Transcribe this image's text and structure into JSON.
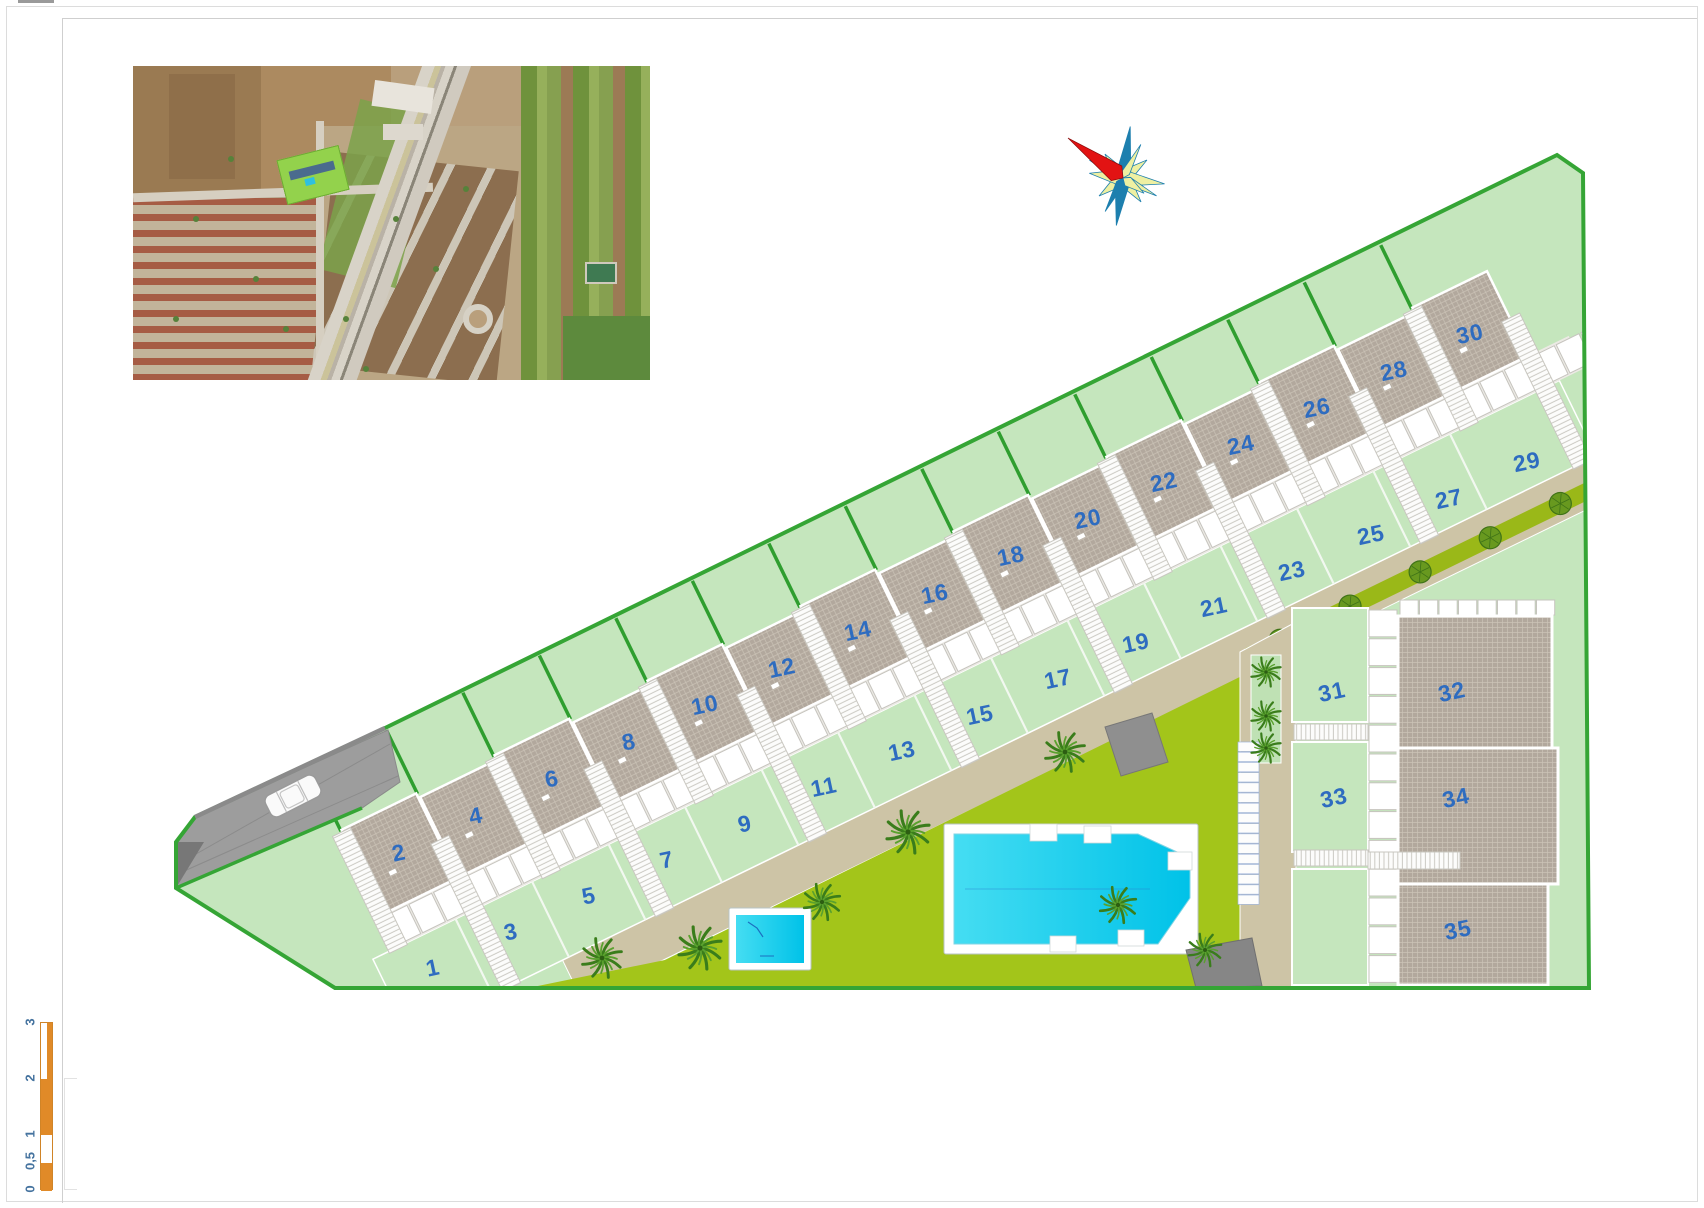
{
  "title": "residential development site plan",
  "colors": {
    "garden_green": "#c5e6bd",
    "lawn_green": "#a3c51a",
    "hedge_green": "#9ab818",
    "boundary_green": "#35a535",
    "roof_taupe": "#b2a89d",
    "path_tan": "#cdc4a6",
    "driveway_gray": "#9d9d9d",
    "pool_cyan": "#22cdec",
    "number_blue": "#2e6cc0",
    "scale_orange": "#e08a28",
    "compass_red": "#e21313",
    "compass_teal": "#1d7fae",
    "compass_yellow": "#eef0a2"
  },
  "plots": [
    {
      "n": "1",
      "x": 433,
      "y": 968,
      "type": "garden"
    },
    {
      "n": "2",
      "x": 399,
      "y": 853,
      "type": "roof"
    },
    {
      "n": "3",
      "x": 511,
      "y": 932,
      "type": "garden"
    },
    {
      "n": "4",
      "x": 476,
      "y": 816,
      "type": "roof"
    },
    {
      "n": "5",
      "x": 589,
      "y": 896,
      "type": "garden"
    },
    {
      "n": "6",
      "x": 552,
      "y": 779,
      "type": "roof"
    },
    {
      "n": "7",
      "x": 667,
      "y": 860,
      "type": "garden"
    },
    {
      "n": "8",
      "x": 629,
      "y": 742,
      "type": "roof"
    },
    {
      "n": "9",
      "x": 745,
      "y": 824,
      "type": "garden"
    },
    {
      "n": "10",
      "x": 705,
      "y": 705,
      "type": "roof"
    },
    {
      "n": "11",
      "x": 824,
      "y": 787,
      "type": "garden"
    },
    {
      "n": "12",
      "x": 782,
      "y": 668,
      "type": "roof"
    },
    {
      "n": "13",
      "x": 902,
      "y": 751,
      "type": "garden"
    },
    {
      "n": "14",
      "x": 858,
      "y": 631,
      "type": "roof"
    },
    {
      "n": "15",
      "x": 980,
      "y": 715,
      "type": "garden"
    },
    {
      "n": "16",
      "x": 935,
      "y": 594,
      "type": "roof"
    },
    {
      "n": "17",
      "x": 1058,
      "y": 679,
      "type": "garden"
    },
    {
      "n": "18",
      "x": 1011,
      "y": 556,
      "type": "roof"
    },
    {
      "n": "19",
      "x": 1136,
      "y": 643,
      "type": "garden"
    },
    {
      "n": "20",
      "x": 1088,
      "y": 519,
      "type": "roof"
    },
    {
      "n": "21",
      "x": 1214,
      "y": 607,
      "type": "garden"
    },
    {
      "n": "22",
      "x": 1164,
      "y": 482,
      "type": "roof"
    },
    {
      "n": "23",
      "x": 1292,
      "y": 571,
      "type": "garden"
    },
    {
      "n": "24",
      "x": 1241,
      "y": 445,
      "type": "roof"
    },
    {
      "n": "25",
      "x": 1371,
      "y": 535,
      "type": "garden"
    },
    {
      "n": "26",
      "x": 1317,
      "y": 408,
      "type": "roof"
    },
    {
      "n": "27",
      "x": 1449,
      "y": 499,
      "type": "garden"
    },
    {
      "n": "28",
      "x": 1394,
      "y": 371,
      "type": "roof"
    },
    {
      "n": "29",
      "x": 1527,
      "y": 462,
      "type": "garden"
    },
    {
      "n": "30",
      "x": 1470,
      "y": 334,
      "type": "roof"
    },
    {
      "n": "31",
      "x": 1332,
      "y": 692,
      "type": "garden"
    },
    {
      "n": "32",
      "x": 1452,
      "y": 692,
      "type": "roof"
    },
    {
      "n": "33",
      "x": 1334,
      "y": 798,
      "type": "garden"
    },
    {
      "n": "34",
      "x": 1456,
      "y": 798,
      "type": "roof"
    },
    {
      "n": "35",
      "x": 1458,
      "y": 930,
      "type": "roof"
    }
  ],
  "scale_bar": {
    "labels": [
      {
        "text": "3",
        "y": 1022
      },
      {
        "text": "2",
        "y": 1078
      },
      {
        "text": "1",
        "y": 1134
      },
      {
        "text": "0,5",
        "y": 1161
      },
      {
        "text": "0",
        "y": 1189
      }
    ]
  }
}
